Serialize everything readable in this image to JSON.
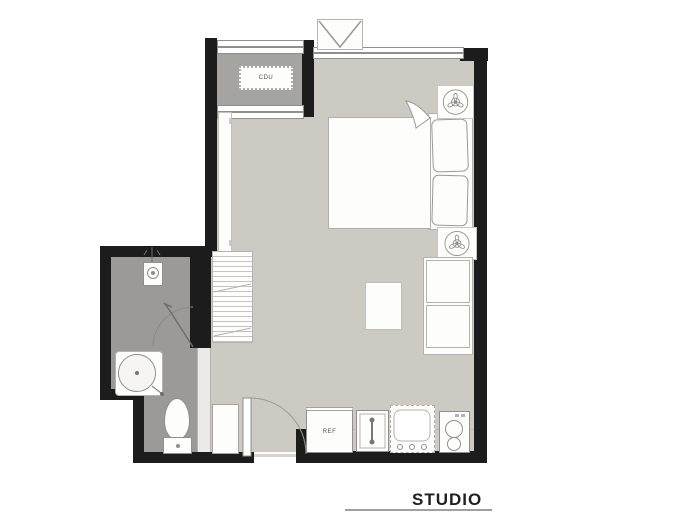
{
  "labels": {
    "cdu": "CDU",
    "ref": "REF",
    "title": "STUDIO"
  },
  "colors": {
    "wall": "#1c1c1c",
    "floor-main": "#cdc9c3",
    "floor-bath": "#9b9a98",
    "floor-balcony": "#a6a4a0",
    "furniture": "#fdfdfc",
    "line": "#8f8f8d",
    "line-light": "#b5b3b0",
    "title": "#1f1f1f",
    "underline": "#a0a0a0"
  },
  "icons": {
    "fan_upper": "fan-icon",
    "fan_lower": "fan-icon",
    "awning_window": "awning-window-icon",
    "shower_head": "shower-head-icon",
    "wash_basin": "round-basin-icon",
    "toilet": "toilet-icon",
    "kitchen_faucet": "faucet-icon",
    "stove_burners": "two-burner-stove-icon",
    "entry_door_swing": "door-swing-arc",
    "bath_door_swing": "door-swing-arc"
  }
}
